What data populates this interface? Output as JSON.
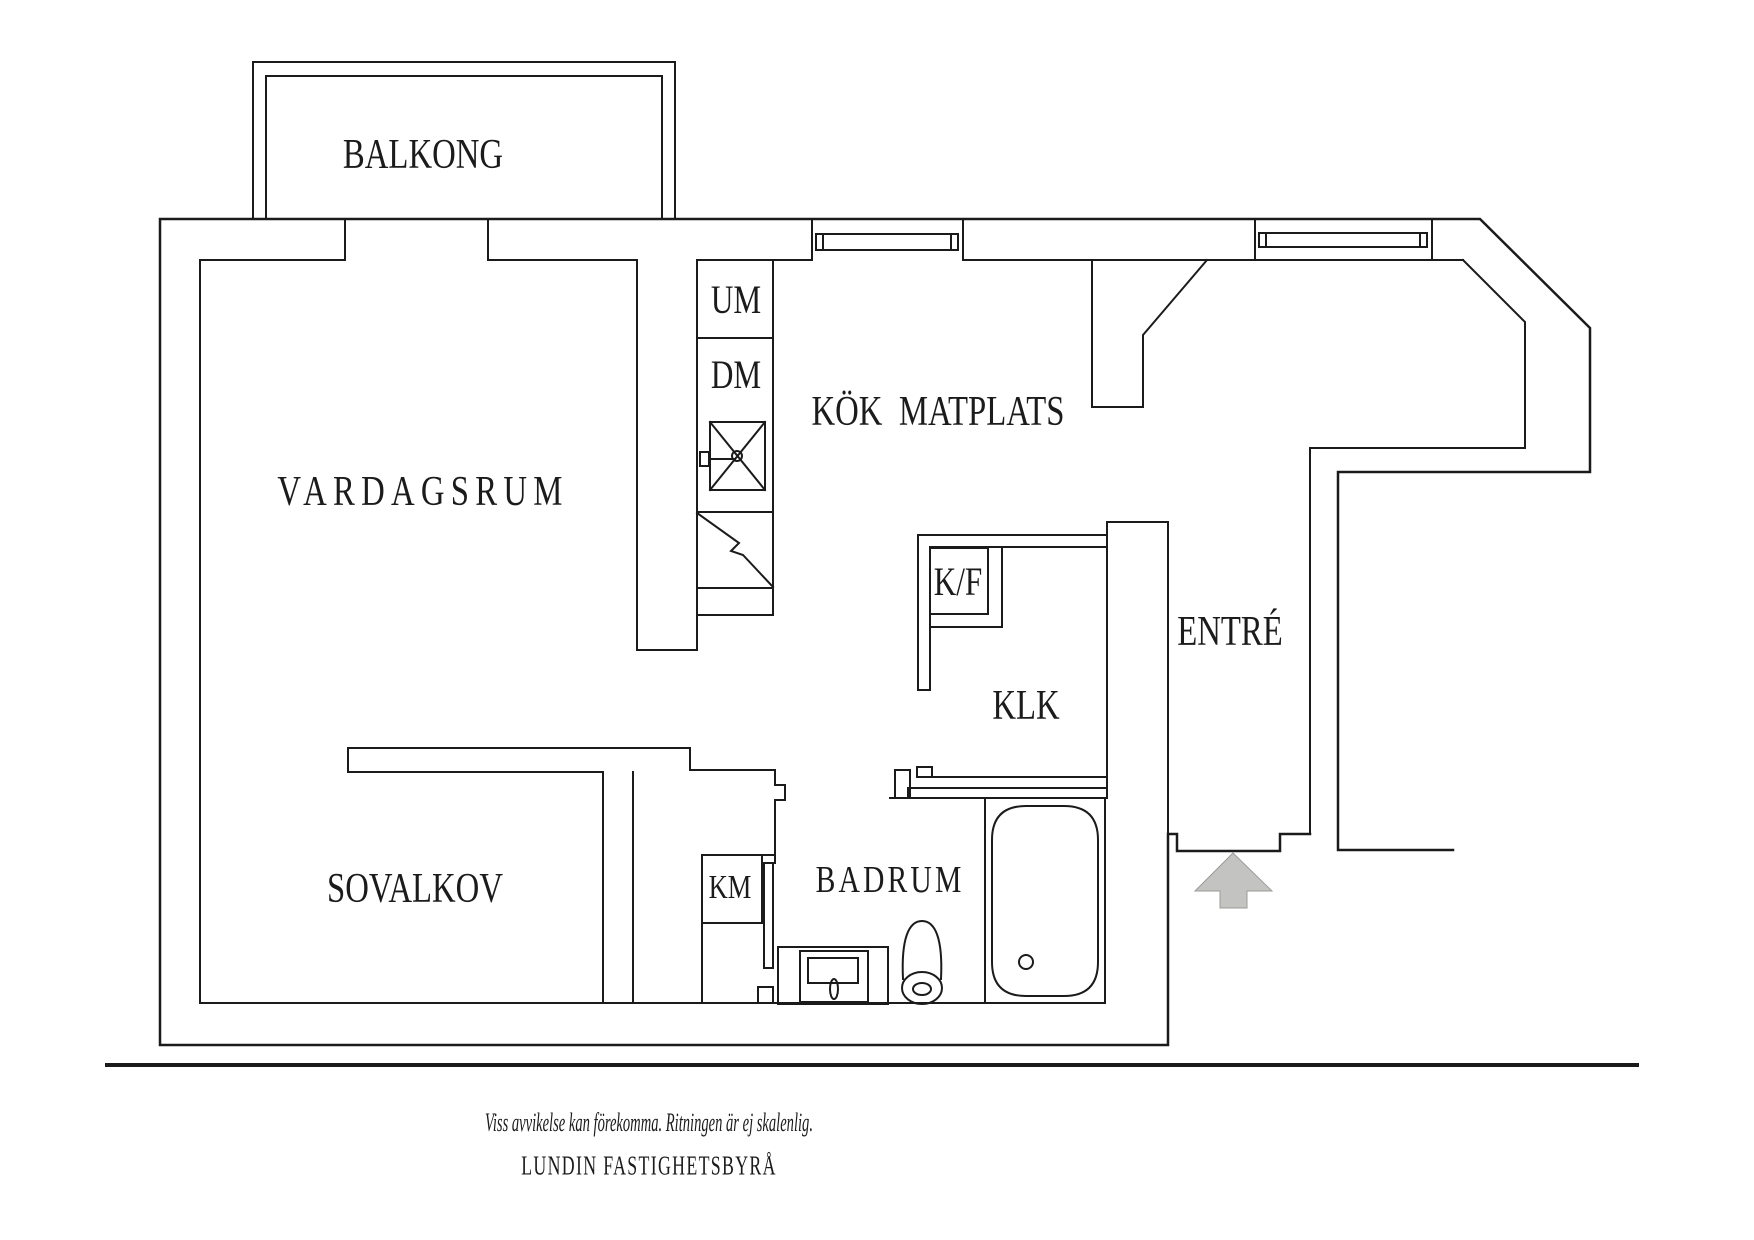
{
  "labels": {
    "balkong": {
      "text": "BALKONG"
    },
    "vardagsrum": {
      "text": "VARDAGSRUM"
    },
    "kok_matplats": {
      "text": "KÖK  MATPLATS"
    },
    "entre": {
      "text": "ENTRÉ"
    },
    "klk": {
      "text": "KLK"
    },
    "kf": {
      "text": "K/F"
    },
    "um": {
      "text": "UM"
    },
    "dm": {
      "text": "DM"
    },
    "km": {
      "text": "KM"
    },
    "sovalkov": {
      "text": "SOVALKOV"
    },
    "badrum": {
      "text": "BADRUM"
    }
  },
  "footer": {
    "disclaimer": "Viss avvikelse kan förekomma. Ritningen är ej skalenlig.",
    "brand": "LUNDIN FASTIGHETSBYRÅ"
  },
  "colors": {
    "line": "#1b1b1b",
    "arrow_fill": "#c3c3c1",
    "arrow_stroke": "#9b9b99",
    "background": "#ffffff"
  }
}
